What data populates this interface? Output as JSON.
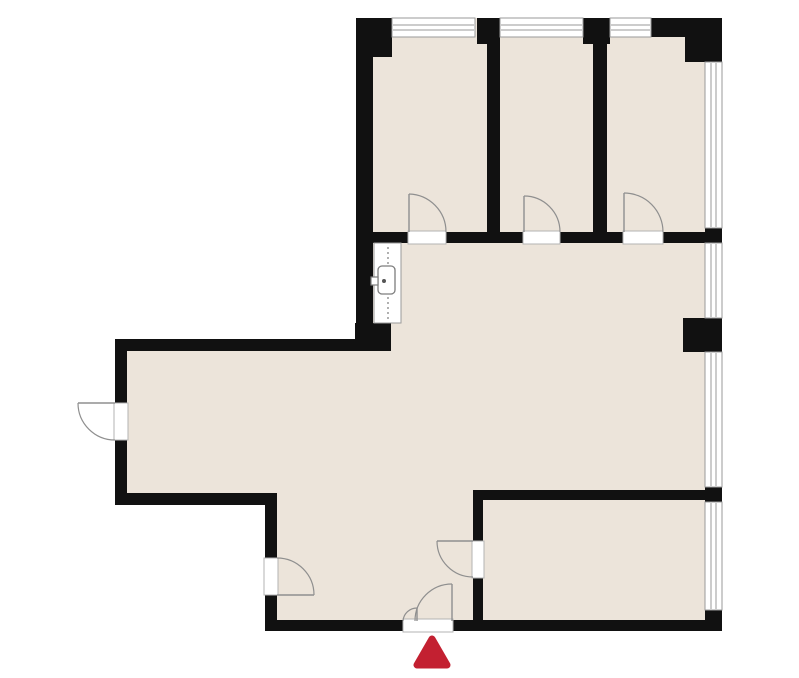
{
  "document": {
    "type": "floor-plan",
    "visible_text": ""
  },
  "colors": {
    "background": "#ffffff",
    "floor": "#ece4da",
    "wall": "#111111",
    "door_line": "#8f8f8f",
    "window_line": "#9a9a9a",
    "threshold_line": "#b3b3b3",
    "fixture_line": "#7d7d7d",
    "entrance_marker": "#c32031"
  },
  "plan": {
    "canvas": {
      "width": 799,
      "height": 678
    },
    "floor_outline": "356,18 722,18 722,631 265,631 265,505 115,505 115,339 356,339",
    "walls": [
      {
        "name": "wall-top-left-corner-block",
        "x": 356,
        "y": 18,
        "w": 36,
        "h": 39
      },
      {
        "name": "wall-left-upper",
        "x": 356,
        "y": 18,
        "w": 17,
        "h": 333
      },
      {
        "name": "wall-top-pier-1",
        "x": 477,
        "y": 18,
        "w": 23,
        "h": 26
      },
      {
        "name": "wall-top-pier-2",
        "x": 583,
        "y": 18,
        "w": 27,
        "h": 26
      },
      {
        "name": "wall-top-right-segment",
        "x": 651,
        "y": 18,
        "w": 71,
        "h": 19
      },
      {
        "name": "wall-top-right-corner-block",
        "x": 685,
        "y": 18,
        "w": 37,
        "h": 44
      },
      {
        "name": "wall-room-divider-1",
        "x": 487,
        "y": 35,
        "w": 13,
        "h": 208
      },
      {
        "name": "wall-room-divider-2",
        "x": 593,
        "y": 35,
        "w": 14,
        "h": 208
      },
      {
        "name": "wall-corridor-a",
        "x": 356,
        "y": 232,
        "w": 52,
        "h": 11
      },
      {
        "name": "wall-corridor-b",
        "x": 446,
        "y": 232,
        "w": 77,
        "h": 11
      },
      {
        "name": "wall-corridor-c",
        "x": 560,
        "y": 232,
        "w": 63,
        "h": 11
      },
      {
        "name": "wall-corridor-d",
        "x": 663,
        "y": 232,
        "w": 42,
        "h": 11
      },
      {
        "name": "wall-right-junction-top",
        "x": 705,
        "y": 228,
        "w": 17,
        "h": 15
      },
      {
        "name": "wall-right-pier",
        "x": 683,
        "y": 318,
        "w": 39,
        "h": 34
      },
      {
        "name": "wall-right-junction-mid",
        "x": 705,
        "y": 487,
        "w": 17,
        "h": 15
      },
      {
        "name": "wall-bottom-right-corner",
        "x": 705,
        "y": 610,
        "w": 17,
        "h": 21
      },
      {
        "name": "wall-wing-top",
        "x": 115,
        "y": 339,
        "w": 258,
        "h": 12
      },
      {
        "name": "wall-wing-left",
        "x": 115,
        "y": 339,
        "w": 12,
        "h": 166
      },
      {
        "name": "wall-wing-bottom",
        "x": 115,
        "y": 493,
        "w": 162,
        "h": 12
      },
      {
        "name": "wall-lower-left",
        "x": 265,
        "y": 493,
        "w": 12,
        "h": 138
      },
      {
        "name": "wall-bottom",
        "x": 265,
        "y": 620,
        "w": 457,
        "h": 11
      },
      {
        "name": "wall-br-room-top",
        "x": 473,
        "y": 490,
        "w": 232,
        "h": 10
      },
      {
        "name": "wall-br-room-left",
        "x": 473,
        "y": 490,
        "w": 10,
        "h": 141
      },
      {
        "name": "wall-sink-corner-block",
        "x": 355,
        "y": 323,
        "w": 36,
        "h": 28
      }
    ],
    "windows": [
      {
        "name": "window-top-1",
        "x": 392,
        "y": 18,
        "w": 83,
        "h": 19,
        "o": "h"
      },
      {
        "name": "window-top-2",
        "x": 500,
        "y": 18,
        "w": 83,
        "h": 19,
        "o": "h"
      },
      {
        "name": "window-top-3",
        "x": 610,
        "y": 18,
        "w": 41,
        "h": 19,
        "o": "h"
      },
      {
        "name": "window-right-1",
        "x": 705,
        "y": 62,
        "w": 17,
        "h": 166,
        "o": "v"
      },
      {
        "name": "window-right-2",
        "x": 705,
        "y": 243,
        "w": 17,
        "h": 75,
        "o": "v"
      },
      {
        "name": "window-right-3",
        "x": 705,
        "y": 352,
        "w": 17,
        "h": 135,
        "o": "v"
      },
      {
        "name": "window-right-4",
        "x": 705,
        "y": 502,
        "w": 17,
        "h": 108,
        "o": "v"
      }
    ],
    "door_gaps": [
      {
        "name": "door-gap-room-1",
        "x": 408,
        "y": 231,
        "w": 38,
        "h": 13
      },
      {
        "name": "door-gap-room-2",
        "x": 523,
        "y": 231,
        "w": 37,
        "h": 13
      },
      {
        "name": "door-gap-room-3",
        "x": 623,
        "y": 231,
        "w": 40,
        "h": 13
      },
      {
        "name": "door-gap-wing-exterior",
        "x": 114,
        "y": 403,
        "w": 14,
        "h": 37
      },
      {
        "name": "door-gap-lower-left",
        "x": 264,
        "y": 558,
        "w": 14,
        "h": 37
      },
      {
        "name": "door-gap-br-room",
        "x": 472,
        "y": 541,
        "w": 12,
        "h": 37
      },
      {
        "name": "door-gap-entrance",
        "x": 403,
        "y": 619,
        "w": 50,
        "h": 13
      }
    ],
    "doors": [
      {
        "name": "door-room-1",
        "leaf": "M409,232 L409,194",
        "arc": "M446,232 A38,38 0 0 0 409,194"
      },
      {
        "name": "door-room-2",
        "leaf": "M524,232 L524,196",
        "arc": "M560,232 A36,36 0 0 0 524,196"
      },
      {
        "name": "door-room-3",
        "leaf": "M624,232 L624,193",
        "arc": "M663,232 A39,39 0 0 0 624,193"
      },
      {
        "name": "door-wing-exterior",
        "leaf": "M78,403 L115,403",
        "arc": "M78,403 A37,37 0 0 0 115,440"
      },
      {
        "name": "door-lower-left",
        "leaf": "M277,595 L314,595",
        "arc": "M277,558 A37,37 0 0 1 314,595"
      },
      {
        "name": "door-br-room",
        "leaf": "M437,541 L473,541",
        "arc": "M437,541 A36,36 0 0 0 473,577"
      },
      {
        "name": "door-entrance-main",
        "leaf": "M452,621 L452,584",
        "arc": "M415,621 A37,37 0 0 1 452,584"
      },
      {
        "name": "door-entrance-small",
        "leaf": "M417,621 L417,608",
        "arc": "M417,608 A14,14 0 0 0 403,621"
      }
    ],
    "fixture": {
      "name": "washbasin-counter",
      "counter": {
        "x": 374,
        "y": 243,
        "w": 27,
        "h": 80
      },
      "dash_line": {
        "x": 388,
        "y1": 247,
        "y2": 321
      },
      "basin": {
        "x": 378,
        "y": 266,
        "w": 17,
        "h": 28,
        "rx": 4
      },
      "faucet_dot": {
        "cx": 384,
        "cy": 281,
        "r": 2
      },
      "handle": {
        "x": 371,
        "y": 277,
        "w": 7,
        "h": 8
      }
    },
    "marker": {
      "name": "entrance-marker",
      "shape": "triangle",
      "points": "432,639 417,665 447,665"
    }
  }
}
